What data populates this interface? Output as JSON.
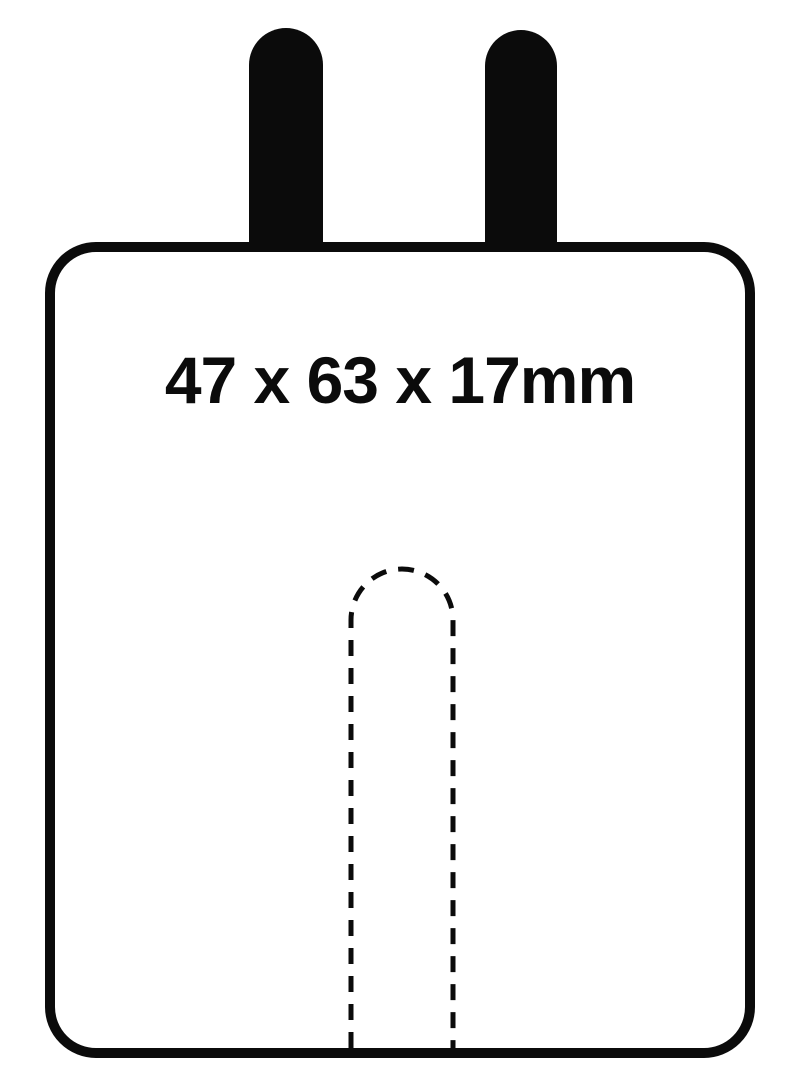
{
  "diagram": {
    "dimension_label": "47 x 63 x 17mm",
    "colors": {
      "ink": "#0b0b0b",
      "background": "#ffffff"
    },
    "shapes": {
      "left_tab": "M 249 252 L 249 65 A 37 37 0 0 1 323 65 L 323 252 Z",
      "right_tab": "M 485 252 L 485 66 A 36 36 0 0 1 557 66 L 557 252 Z",
      "dashed_slot": "M 351 1048 L 351 620 A 51 51 0 0 1 453 620 L 453 1050",
      "dash_pattern": "16 12"
    }
  }
}
